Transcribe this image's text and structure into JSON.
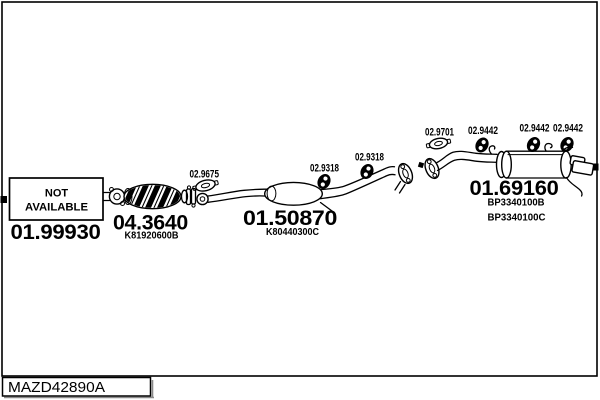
{
  "palette": {
    "ink": "#000000",
    "paper": "#ffffff"
  },
  "frame": {
    "code": "MAZD42890A"
  },
  "not_available_box": {
    "line1": "NOT",
    "line2": "AVAILABLE"
  },
  "parts": {
    "front_pipe": {
      "number": "01.99930"
    },
    "catalyst": {
      "number": "04.3640",
      "oem": "K81920600B"
    },
    "front_gasket": {
      "number": "02.9675"
    },
    "middle_muffler": {
      "number": "01.50870",
      "oem": "K80440300C"
    },
    "hanger_mid_1": {
      "number": "02.9318"
    },
    "hanger_mid_2": {
      "number": "02.9318"
    },
    "rear_gasket": {
      "number": "02.9701"
    },
    "hanger_rear_1": {
      "number": "02.9442"
    },
    "hanger_rear_2": {
      "number": "02.9442"
    },
    "hanger_rear_3": {
      "number": "02.9442"
    },
    "rear_muffler": {
      "number": "01.69160",
      "oem": "BP3340100B",
      "oem_alt": "BP3340100C"
    }
  },
  "icons": {
    "gasket": "flange-gasket-icon",
    "hanger": "rubber-hanger-icon",
    "flange": "pipe-flange-icon",
    "connector": "connection-marker-square"
  }
}
